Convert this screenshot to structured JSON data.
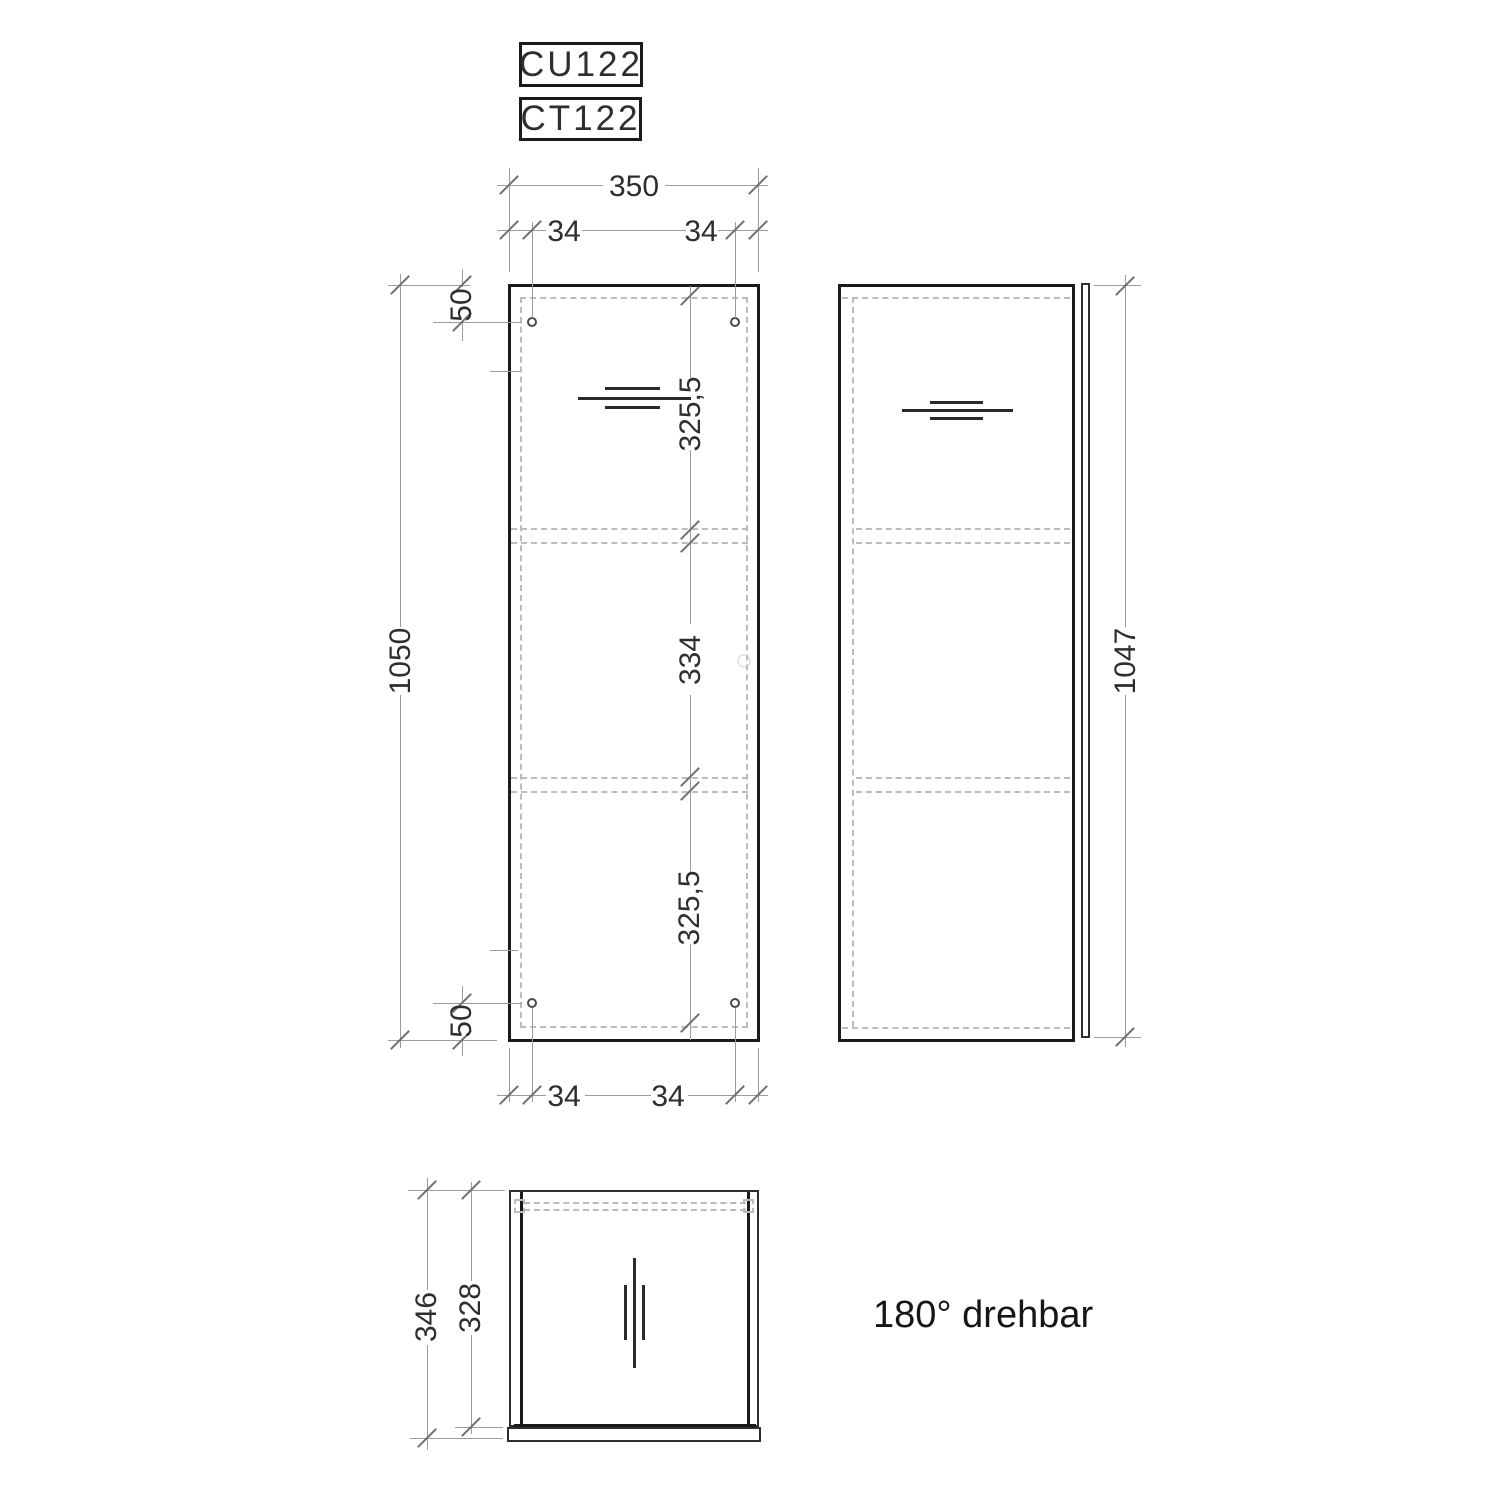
{
  "titles": {
    "model_top": "CU122",
    "model_bottom": "CT122"
  },
  "note": {
    "rotation_text": "180° drehbar"
  },
  "front_view": {
    "width": "350",
    "hole_inset_top_left": "34",
    "hole_inset_top_right": "34",
    "hole_inset_top": "50",
    "section_top": "325,5",
    "section_middle": "334",
    "section_bottom": "325,5",
    "height": "1050",
    "hole_inset_bottom": "50",
    "hole_inset_bottom_left": "34",
    "hole_inset_bottom_right": "34"
  },
  "side_view": {
    "height": "1047"
  },
  "bottom_view": {
    "depth_total": "346",
    "depth_inner": "328"
  },
  "colors": {
    "outline": "#1b1b1b",
    "dimension_line": "#9c9c9c",
    "dashed_line": "#bcbcbc",
    "text": "#2e2e2e"
  }
}
